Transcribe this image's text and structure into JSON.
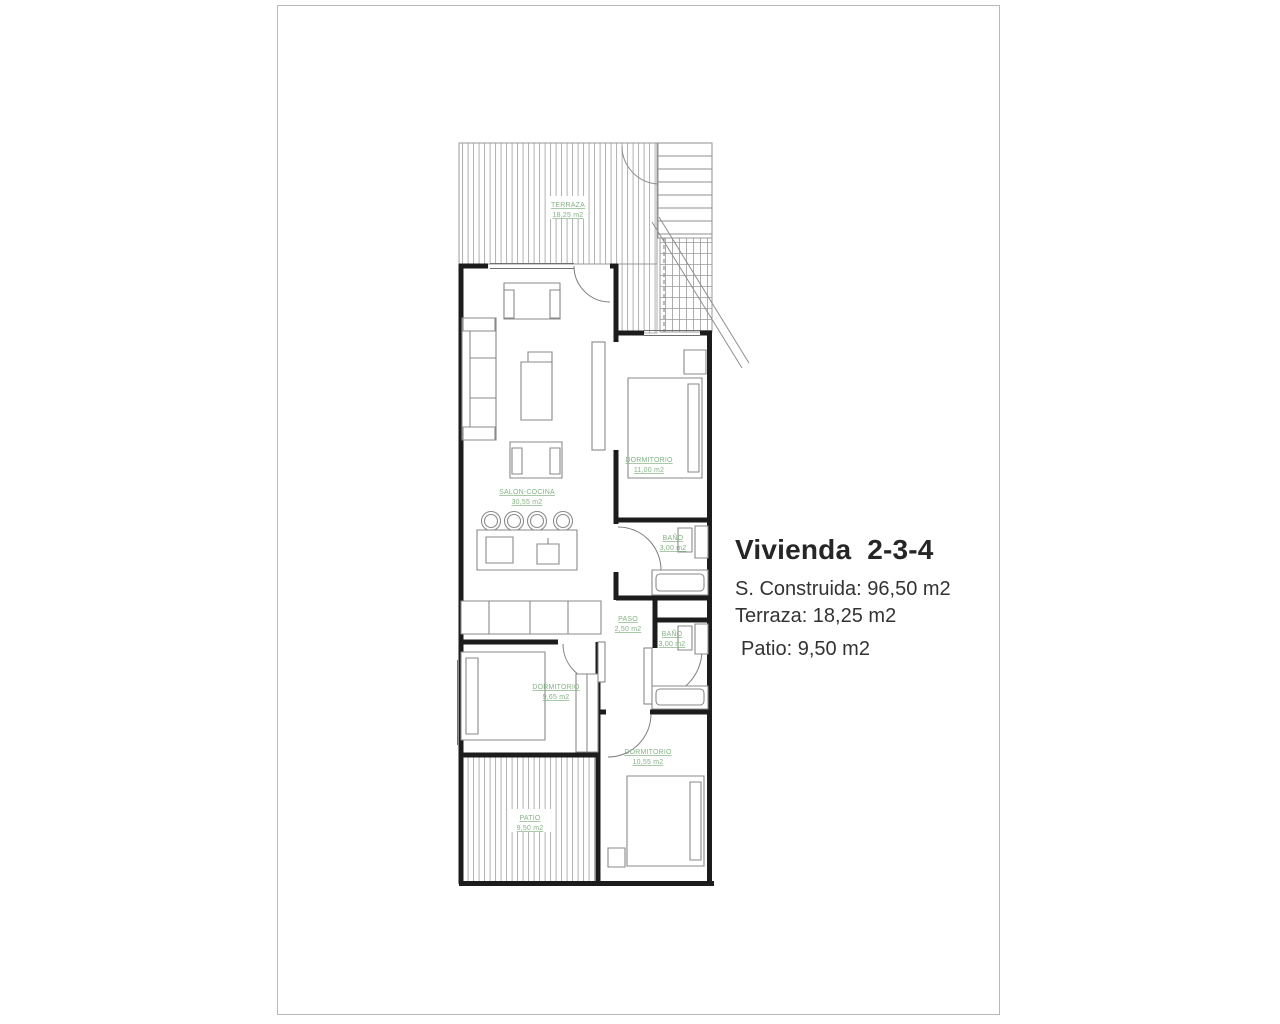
{
  "sheet": {
    "background": "#ffffff",
    "border_color": "#b8b8b8"
  },
  "info_panel": {
    "title": "Vivienda  2-3-4",
    "construida": "S. Construida: 96,50 m2",
    "terraza": "Terraza: 18,25 m2",
    "patio": "Patio: 9,50 m2"
  },
  "floorplan": {
    "label_color": "#84b284",
    "wall_color": "#1c1c1c",
    "rooms": [
      {
        "name": "TERRAZA",
        "area": "18,25 m2"
      },
      {
        "name": "SALON-COCINA",
        "area": "30,55 m2"
      },
      {
        "name": "DORMITORIO",
        "area": "11,00 m2"
      },
      {
        "name": "BAÑO",
        "area": "3,00 m2"
      },
      {
        "name": "PASO",
        "area": "2,50 m2"
      },
      {
        "name": "BAÑO",
        "area": "3,00 m2"
      },
      {
        "name": "DORMITORIO",
        "area": "9,65 m2"
      },
      {
        "name": "PATIO",
        "area": "9,50 m2"
      },
      {
        "name": "DORMITORIO",
        "area": "10,55 m2"
      }
    ]
  }
}
